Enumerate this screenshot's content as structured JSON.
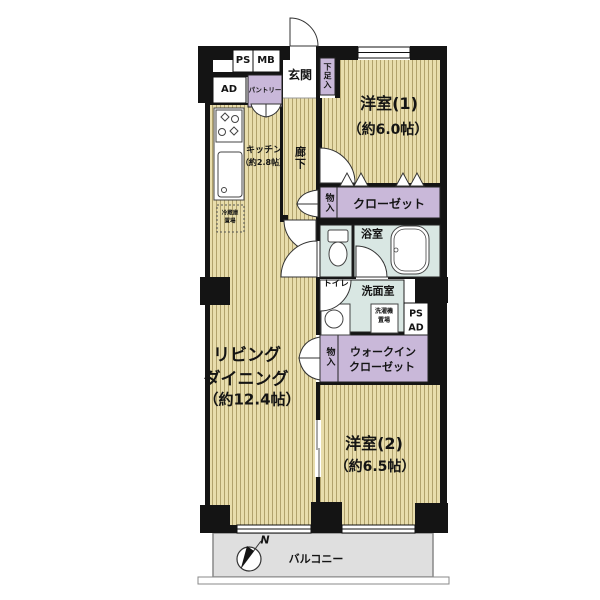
{
  "floorplan": {
    "colors": {
      "wall": "#141414",
      "floor": "#E8DDAC",
      "floor_stripe": "#B1A26C",
      "closet": "#C9B8D9",
      "wet": "#D9E7E3",
      "balcony": "#DFDFDF"
    },
    "labels": {
      "ps": "PS",
      "mb": "MB",
      "ad": "AD",
      "pantry": "パントリー",
      "entrance": "玄関",
      "shoe": "下足入",
      "room1_name": "洋室(1)",
      "room1_size": "（約6.0帖）",
      "closet": "クローゼット",
      "storage_upper": "物入",
      "corridor": "廊下",
      "kitchen_name": "キッチン",
      "kitchen_size": "（約2.8帖）",
      "fridge1": "冷蔵庫",
      "fridge2": "置場",
      "bath": "浴室",
      "toilet": "トイレ",
      "washroom": "洗面室",
      "washer1": "洗濯機",
      "washer2": "置場",
      "ps2": "PS",
      "ad2": "AD",
      "wic1": "ウォークイン",
      "wic2": "クローゼット",
      "storage_lower": "物入",
      "ld1": "リビング",
      "ld2": "ダイニング",
      "ld_size": "（約12.4帖）",
      "room2_name": "洋室(2)",
      "room2_size": "（約6.5帖）",
      "balcony": "バルコニー",
      "north": "N"
    }
  }
}
